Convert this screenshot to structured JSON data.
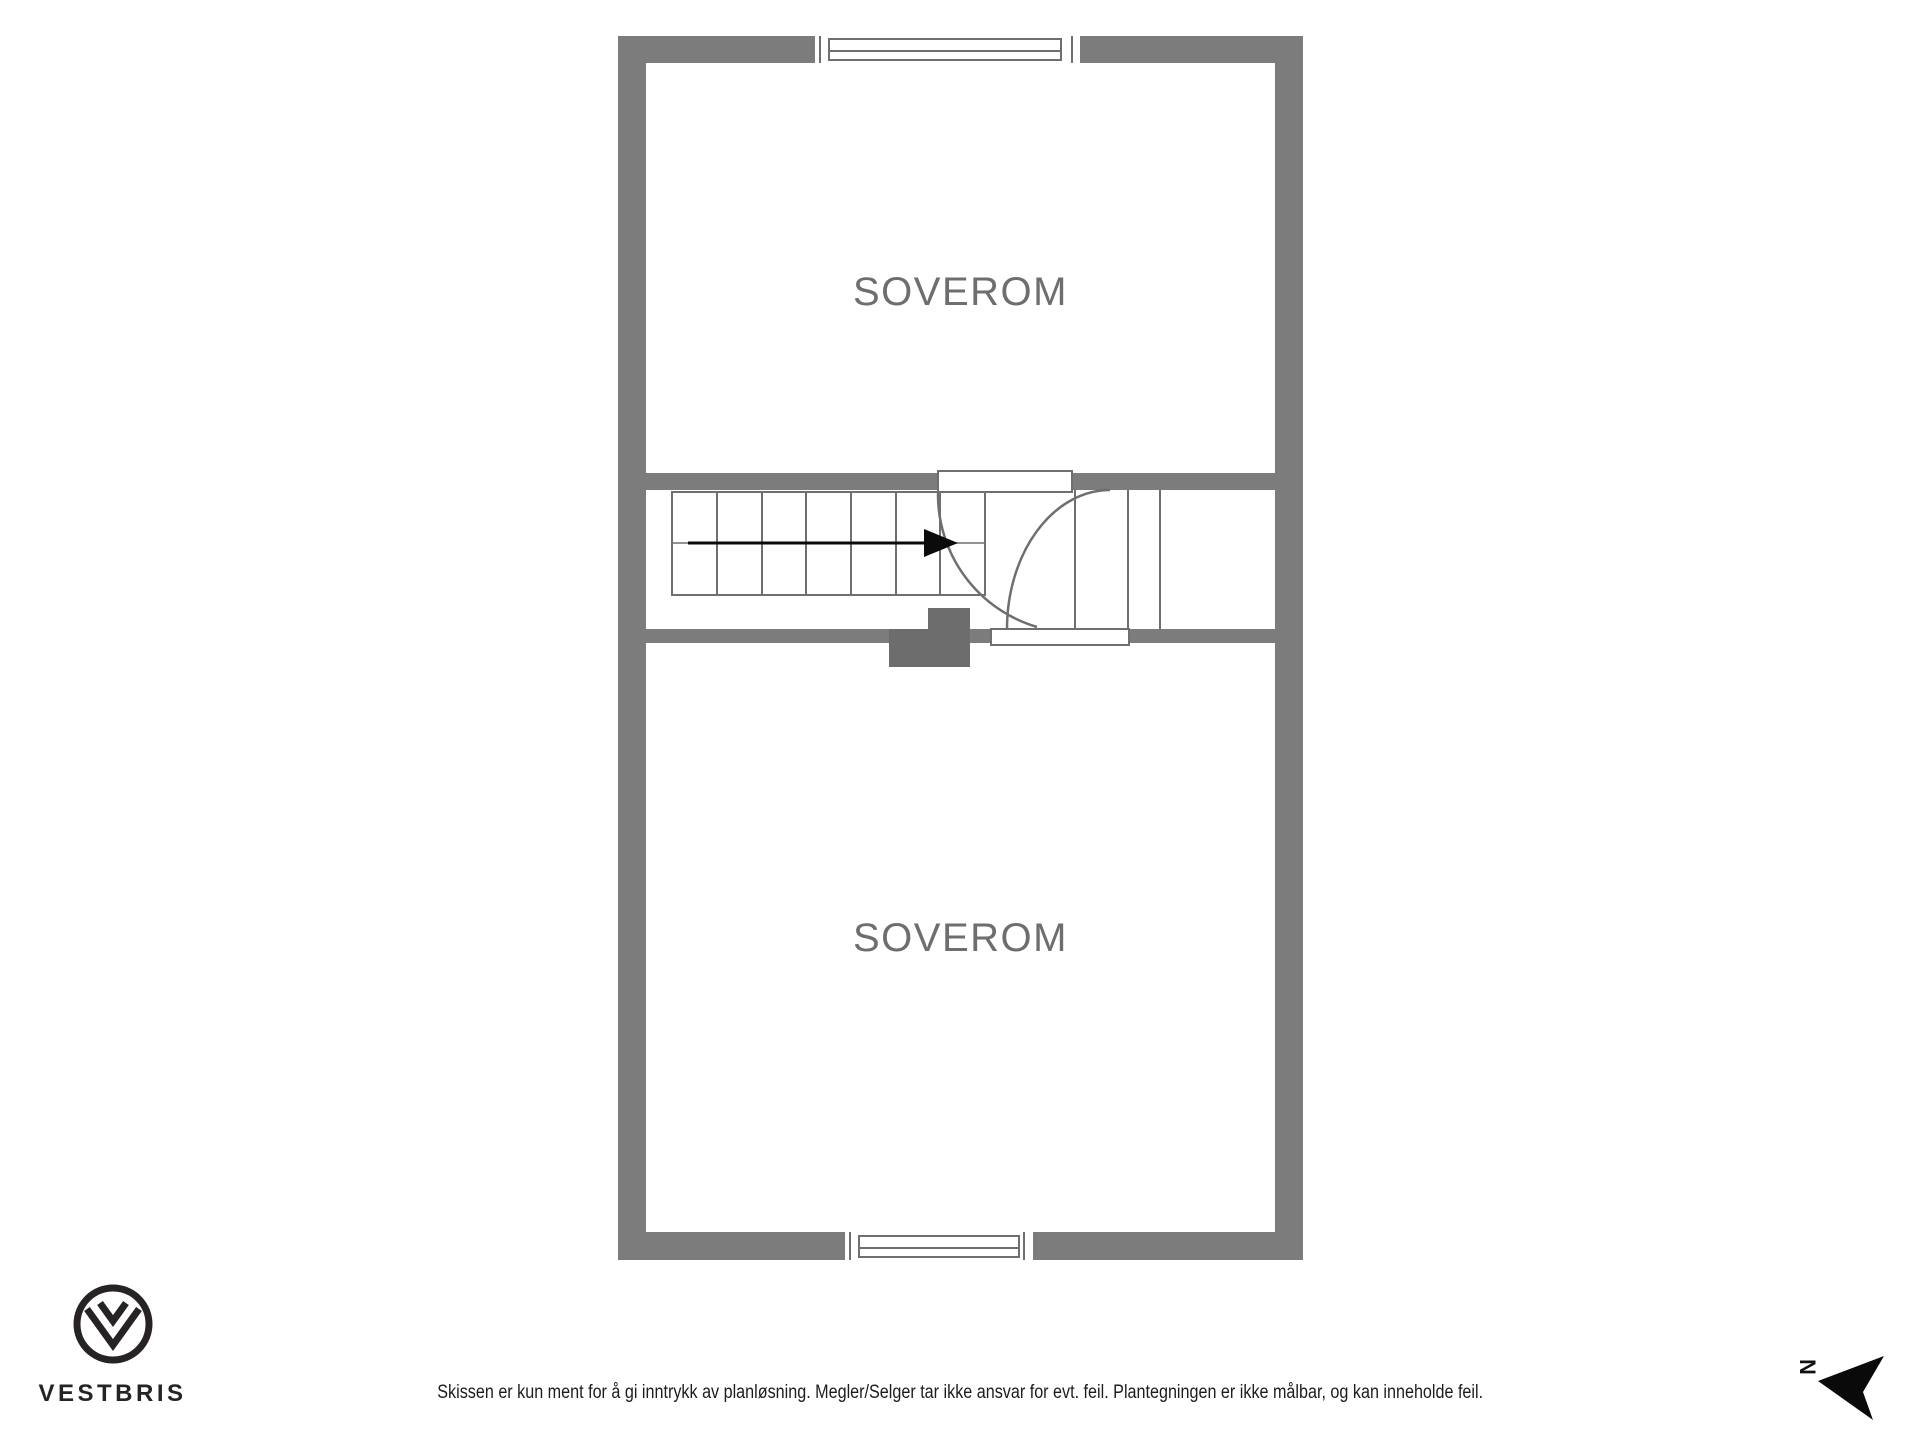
{
  "floorplan": {
    "room_labels": [
      "SOVEROM",
      "SOVEROM"
    ]
  },
  "footer": {
    "brand": "VESTBRIS",
    "disclaimer": "Skissen er kun ment for å gi inntrykk av planløsning. Megler/Selger tar ikke ansvar for evt. feil. Plantegningen er ikke målbar, og kan inneholde feil.",
    "north_label": "N"
  },
  "colors": {
    "wall": "#7c7c7c",
    "chimney": "#6d6d6d",
    "line": "#6f6f6f",
    "room_label": "#6e6e6e",
    "arrow": "#0b0b0b",
    "brand_dark": "#272324"
  }
}
